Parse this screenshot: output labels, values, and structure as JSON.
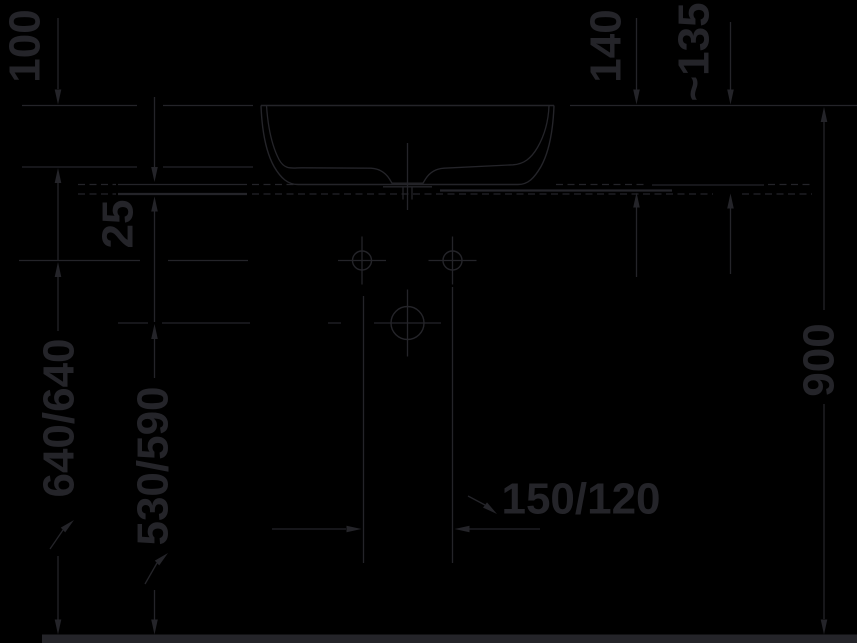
{
  "colors": {
    "background": "#000000",
    "ink": "#242429"
  },
  "drawing": {
    "type": "technical-dimension-drawing",
    "subject": "washbasin front elevation with installation dimensions",
    "unit": "mm",
    "labels": {
      "basin_depth": "100",
      "console_gap": "25",
      "rim_to_console_left": "140",
      "rim_to_console_right": "~135",
      "rim_height": "900",
      "tap_hole_height": "640/640",
      "drain_height": "530/590",
      "hole_spacing": "150/120"
    }
  }
}
